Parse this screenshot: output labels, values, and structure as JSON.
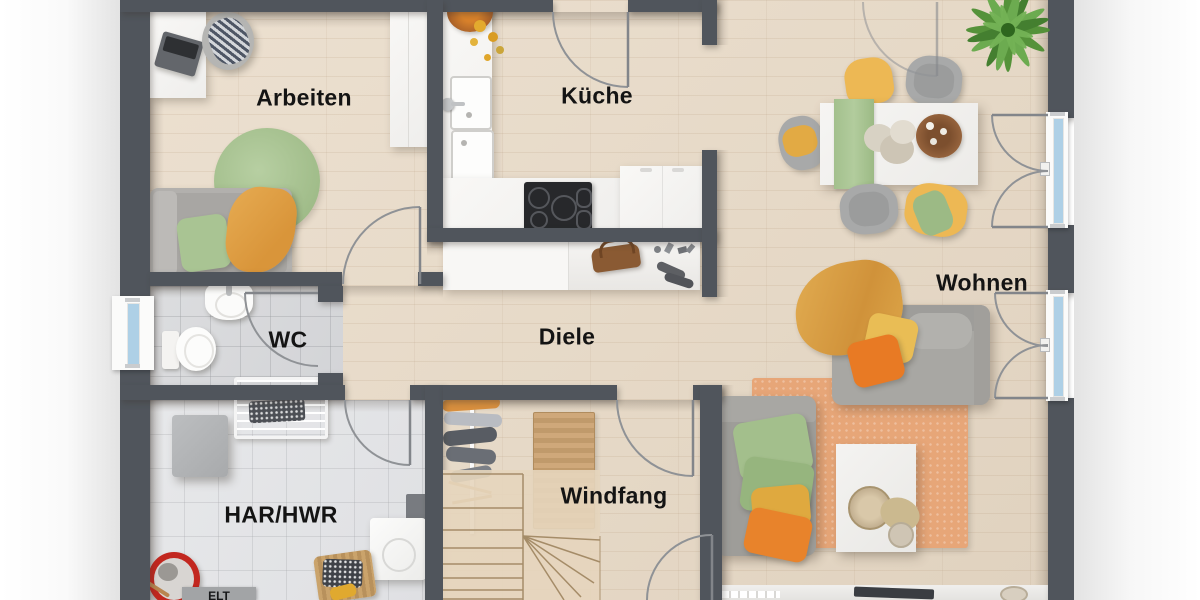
{
  "rooms": {
    "arbeiten": {
      "label": "Arbeiten"
    },
    "kueche": {
      "label": "Küche"
    },
    "wohnen": {
      "label": "Wohnen"
    },
    "wc": {
      "label": "WC"
    },
    "diele": {
      "label": "Diele"
    },
    "har_hwr": {
      "label": "HAR/HWR"
    },
    "windfang": {
      "label": "Windfang"
    },
    "elt": {
      "label": "ELT"
    }
  },
  "colors": {
    "wall": "#50555c",
    "floor_wood": "#e7dac8",
    "floor_tile_wc": "#d6d7d9",
    "floor_tile_hwr": "#e3e4e6",
    "window_glass": "#aed0e6",
    "door_arc": "#8f9296",
    "accent_orange": "#e87a24",
    "accent_ochre": "#dda649",
    "accent_yellow": "#e9bd55",
    "accent_green": "#a3bf8c",
    "rug_terracotta": "#e7a678",
    "rug_green": "#aac79a",
    "sofa_gray": "#a19f9b",
    "counter_white": "#f5f4f2",
    "cooktop_black": "#27282b",
    "label_text": "#141414"
  }
}
